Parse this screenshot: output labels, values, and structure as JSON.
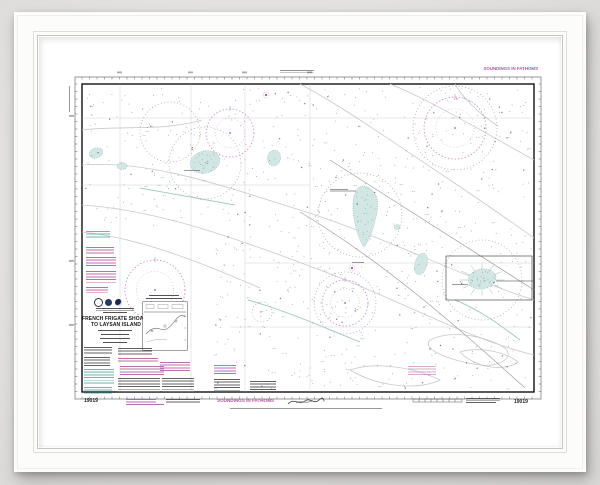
{
  "chart": {
    "title": {
      "line1": "FRENCH FRIGATE SHOALS",
      "line2": "TO LAYSAN ISLAND"
    },
    "chart_number_left": "19019",
    "chart_number_right": "19019",
    "soundings_label_top": "SOUNDINGS IN FATHOMS",
    "soundings_label_bottom": "SOUNDINGS IN FATHOMS",
    "colors": {
      "magenta": "#b0549e",
      "teal": "#58a89e",
      "shoal_fill": "#d2e6e3",
      "shoal_edge": "#8fb6b2",
      "ink": "#2e2e2e",
      "contour_gray": "#c9c9c9",
      "contour_green": "#a8cdbb",
      "grid": "#bdbdbd"
    }
  }
}
